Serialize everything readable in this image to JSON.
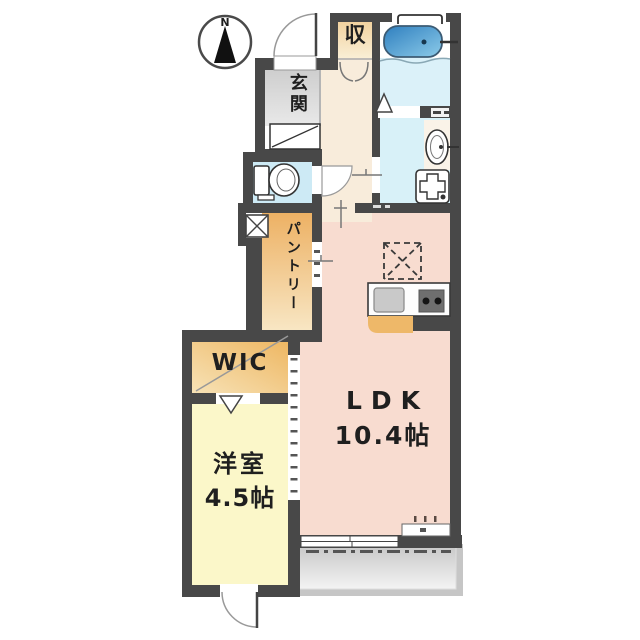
{
  "compass": {
    "north_label": "N"
  },
  "rooms": {
    "storage": {
      "label": "収"
    },
    "entrance": {
      "label": "玄関"
    },
    "pantry": {
      "label": "パントリー"
    },
    "wic": {
      "label": "WIC"
    },
    "western": {
      "label": "洋室",
      "size": "4.5帖"
    },
    "ldk": {
      "label": "LDK",
      "size": "10.4帖"
    }
  },
  "palette": {
    "wall": "#484848",
    "entrance-floor": "#d6d6d6",
    "hall-floor": "#f8ecdb",
    "toilet-floor": "#cdeaf5",
    "washroom-floor": "#d8f1f8",
    "bath-floor": "#dbf1f9",
    "ldk-floor": "#f8dcd0",
    "western-floor": "#fbf7c9",
    "tub-blue": "#3e93cf",
    "cabinet-orange": "#eeb869"
  }
}
